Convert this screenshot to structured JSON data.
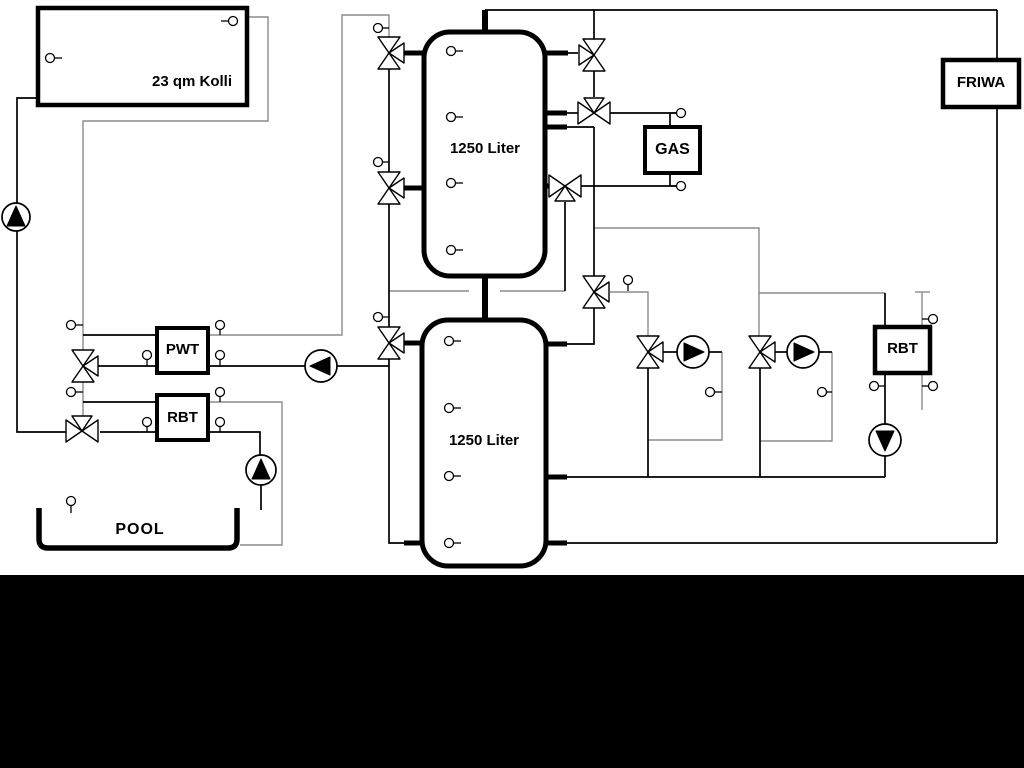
{
  "schematic": {
    "collector_label": "23 qm Kolli",
    "tank_top_label": "1250 Liter",
    "tank_bottom_label": "1250 Liter",
    "gas_label": "GAS",
    "friwa_label": "FRIWA",
    "pwt_label": "PWT",
    "rbt_left_label": "RBT",
    "rbt_right_label": "RBT",
    "pool_label": "POOL",
    "colors": {
      "line_black": "#000000",
      "line_gray": "#8c8c8c",
      "background": "#ffffff",
      "bottom_band": "#000000",
      "component_fill": "#ffffff"
    },
    "icons": [
      "pump-icon",
      "three-way-valve-icon",
      "temperature-sensor-icon"
    ]
  }
}
